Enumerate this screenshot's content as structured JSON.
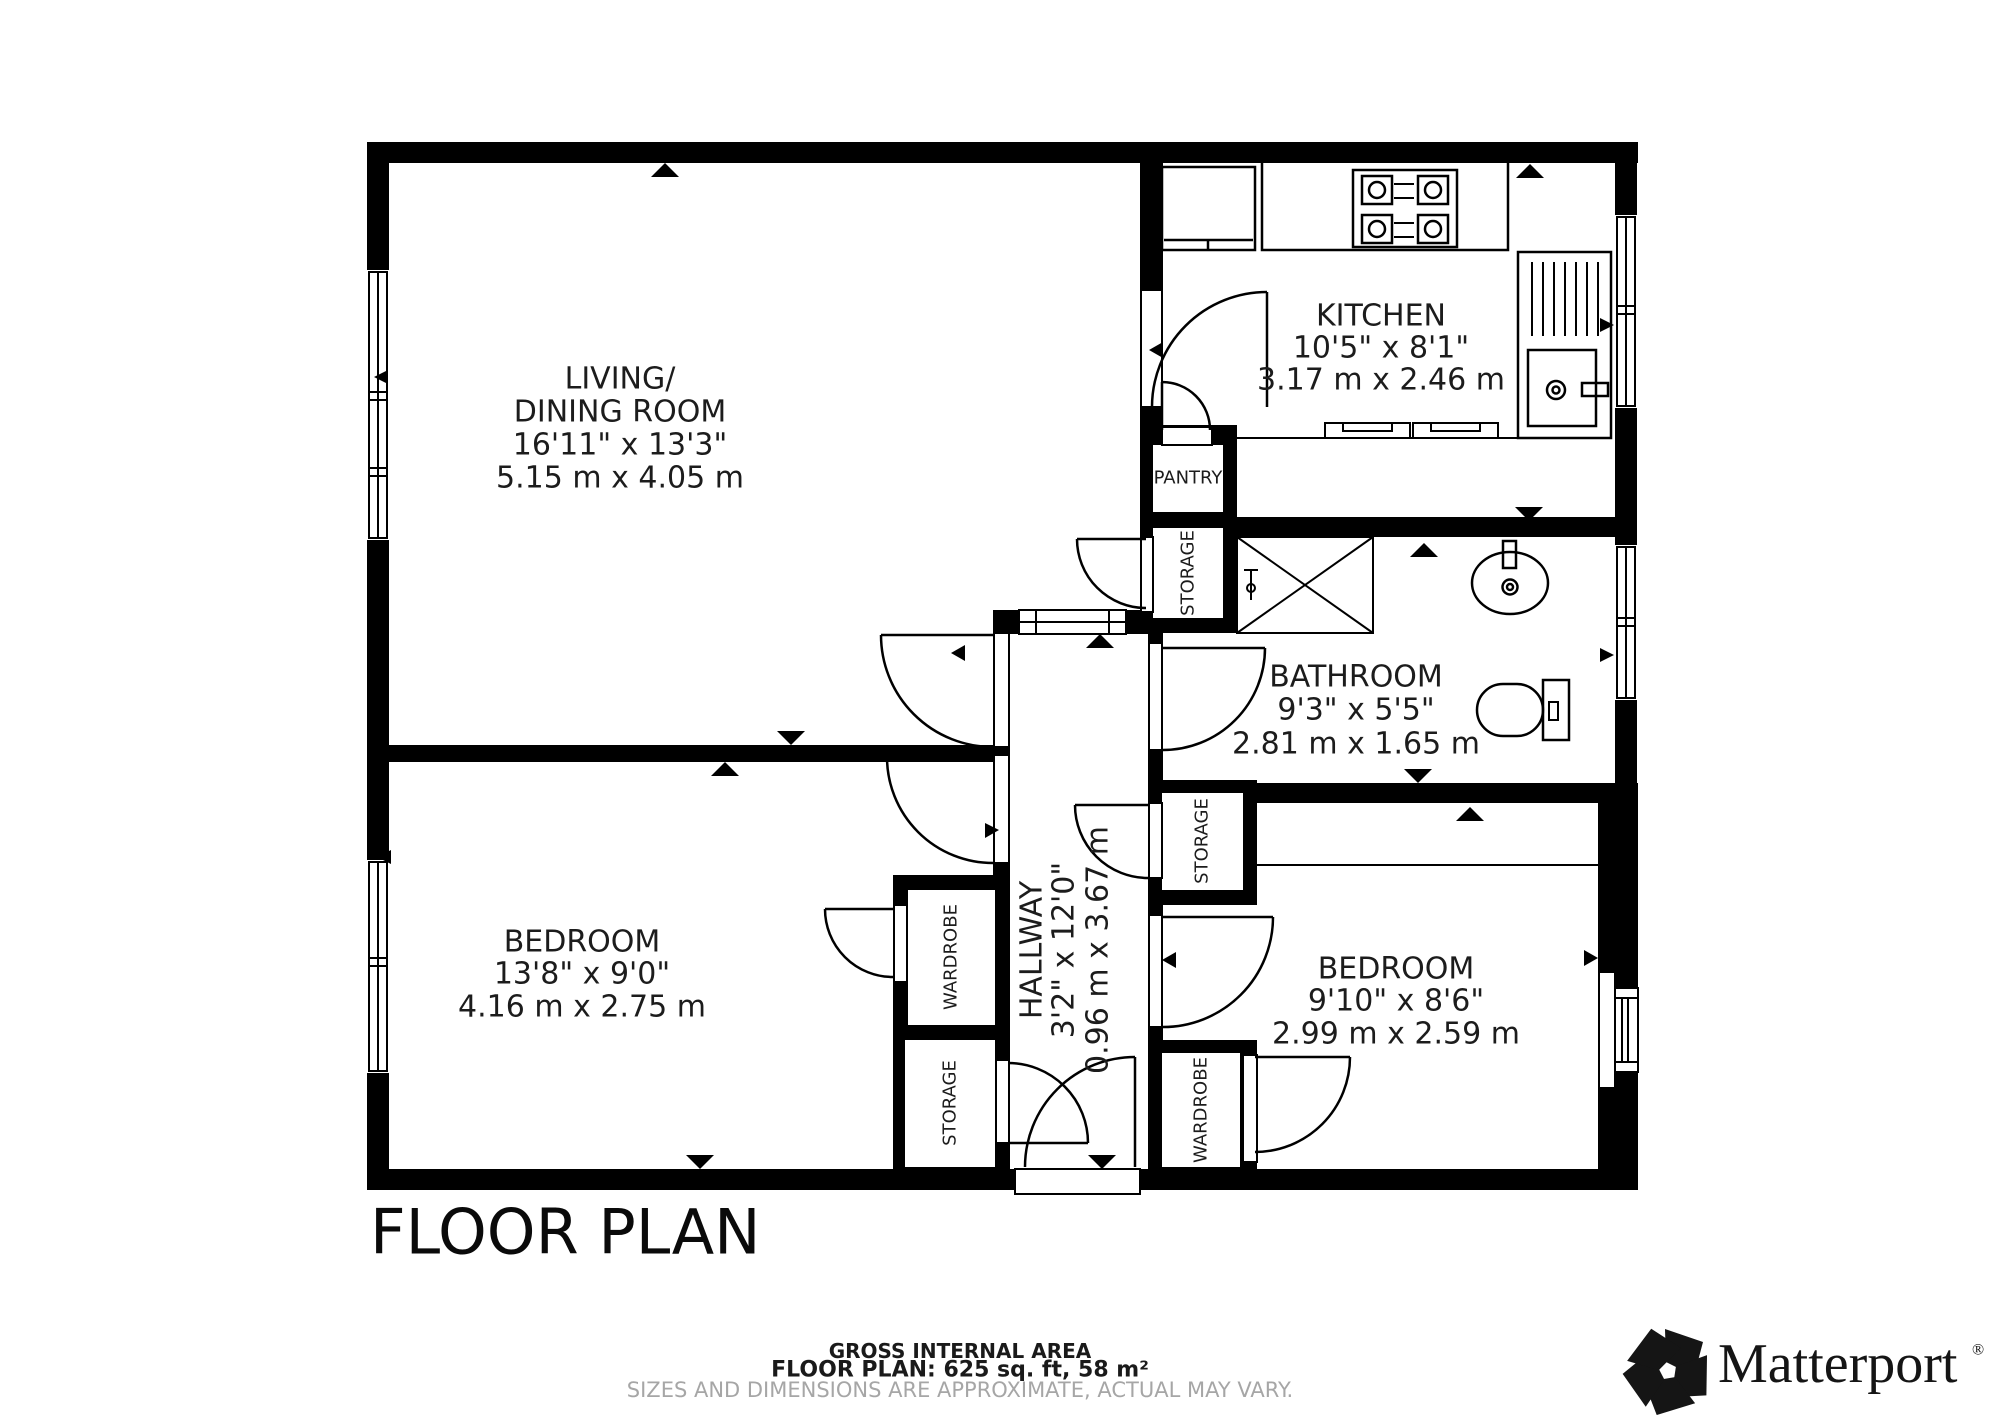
{
  "title": "FLOOR PLAN",
  "rooms": {
    "living": {
      "name1": "LIVING/",
      "name2": "DINING ROOM",
      "imperial": "16'11\" x 13'3\"",
      "metric": "5.15 m x 4.05 m"
    },
    "kitchen": {
      "name": "KITCHEN",
      "imperial": "10'5\" x 8'1\"",
      "metric": "3.17 m x 2.46 m"
    },
    "bathroom": {
      "name": "BATHROOM",
      "imperial": "9'3\" x 5'5\"",
      "metric": "2.81 m x 1.65 m"
    },
    "bedroom_left": {
      "name": "BEDROOM",
      "imperial": "13'8\" x 9'0\"",
      "metric": "4.16 m x 2.75 m"
    },
    "bedroom_right": {
      "name": "BEDROOM",
      "imperial": "9'10\" x 8'6\"",
      "metric": "2.99 m x 2.59 m"
    },
    "hallway": {
      "name": "HALLWAY",
      "imperial": "3'2\" x 12'0\"",
      "metric": "0.96 m x 3.67 m"
    },
    "pantry": {
      "name": "PANTRY"
    },
    "storage_upper": {
      "name": "STORAGE"
    },
    "storage_mid": {
      "name": "STORAGE"
    },
    "storage_lower": {
      "name": "STORAGE"
    },
    "wardrobe_left": {
      "name": "WARDROBE"
    },
    "wardrobe_right": {
      "name": "WARDROBE"
    }
  },
  "footer": {
    "line1": "GROSS INTERNAL AREA",
    "line2": "FLOOR PLAN: 625 sq. ft, 58 m²",
    "line3": "SIZES AND DIMENSIONS ARE APPROXIMATE, ACTUAL MAY VARY."
  },
  "brand": {
    "name": "Matterport",
    "registered": "®"
  },
  "colors": {
    "wall": "#000000",
    "floor": "#ffffff",
    "disclaimer": "#a6a6a6"
  }
}
